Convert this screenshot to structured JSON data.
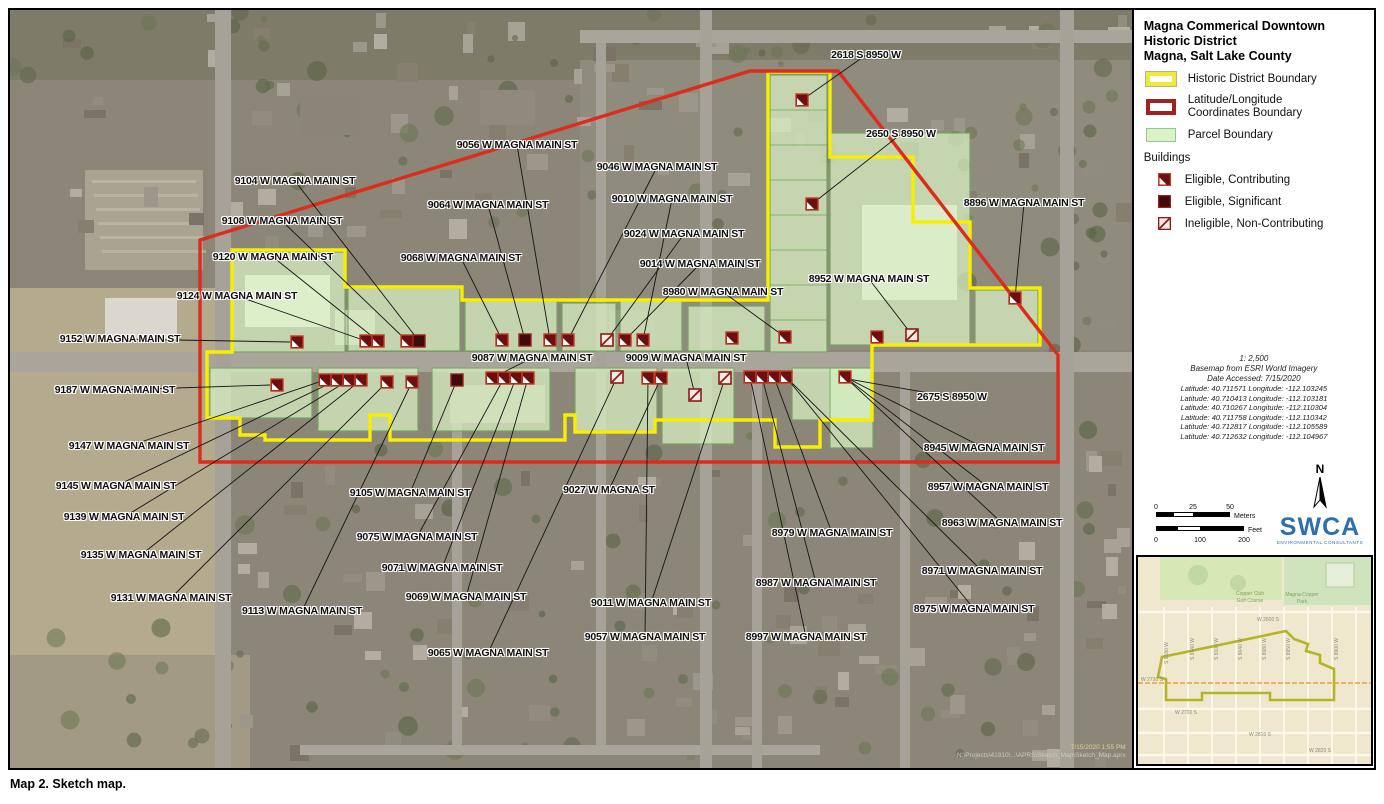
{
  "caption": "Map 2. Sketch map.",
  "legend": {
    "title_lines": [
      "Magna Commerical Downtown",
      "Historic District",
      "Magna, Salt Lake County"
    ],
    "items": [
      {
        "label": "Historic District Boundary",
        "swatch": "yellow",
        "color": "#f2e83a"
      },
      {
        "label": "Latitude/Longitude\nCoordinates Boundary",
        "swatch": "red",
        "color": "#9e2123"
      },
      {
        "label": "Parcel Boundary",
        "swatch": "green",
        "color": "#daf2c6"
      }
    ],
    "buildings_header": "Buildings",
    "building_types": [
      {
        "type": "c",
        "label": "Eligible, Contributing"
      },
      {
        "type": "s",
        "label": "Eligible, Significant"
      },
      {
        "type": "n",
        "label": "Ineligible, Non-Contributing"
      }
    ]
  },
  "scale_info": {
    "ratio": "1: 2,500",
    "basemap": "Basemap from ESRI World Imagery",
    "date": "Date Accessed: 7/15/2020",
    "coordinates": [
      "Latitude: 40.711571 Longitude: -112.103245",
      "Latitude: 40.710413 Longitude: -112.103181",
      "Latitude: 40.710267 Longitude: -112.110304",
      "Latitude: 40.711758 Longitude: -112.110342",
      "Latitude: 40.712817 Longitude: -112.105589",
      "Latitude: 40.712632 Longitude: -112.104967"
    ]
  },
  "scale_bar": {
    "meters_ticks": [
      "0",
      "25",
      "50"
    ],
    "meters_label": "Meters",
    "feet_ticks": [
      "0",
      "100",
      "200"
    ],
    "feet_label": "Feet"
  },
  "north_label": "N",
  "logo": {
    "text": "SWCA",
    "subtext": "ENVIRONMENTAL CONSULTANTS"
  },
  "map": {
    "boundary_colors": {
      "historic": "#f7ee00",
      "latlong": "#dd2b1c",
      "parcel_fill": "#d9f2c4",
      "parcel_stroke": "#6fae57"
    },
    "stamp": [
      "7/15/2020 1:55 PM",
      "N:\\Projects\\41910\\...\\APRS\\Sketch_Map\\Sketch_Map.aprx"
    ],
    "labels": [
      {
        "t": "2618 S 8950 W",
        "x": 866,
        "y": 55,
        "lead": [
          802,
          100
        ]
      },
      {
        "t": "2650 S 8950 W",
        "x": 901,
        "y": 134,
        "lead": [
          812,
          204
        ]
      },
      {
        "t": "9056 W MAGNA MAIN ST",
        "x": 517,
        "y": 145,
        "lead": [
          550,
          340
        ]
      },
      {
        "t": "9046 W MAGNA MAIN ST",
        "x": 657,
        "y": 167,
        "lead": [
          568,
          340
        ]
      },
      {
        "t": "9104 W MAGNA MAIN ST",
        "x": 295,
        "y": 181,
        "lead": [
          419,
          341
        ]
      },
      {
        "t": "9010 W MAGNA MAIN ST",
        "x": 672,
        "y": 199,
        "lead": [
          643,
          340
        ]
      },
      {
        "t": "8896 W MAGNA MAIN ST",
        "x": 1024,
        "y": 203,
        "lead": [
          1015,
          298
        ]
      },
      {
        "t": "9064 W MAGNA MAIN ST",
        "x": 488,
        "y": 205,
        "lead": [
          525,
          340
        ]
      },
      {
        "t": "9108 W MAGNA MAIN ST",
        "x": 282,
        "y": 221,
        "lead": [
          407,
          341
        ]
      },
      {
        "t": "9024 W MAGNA MAIN ST",
        "x": 684,
        "y": 234,
        "lead": [
          607,
          340
        ]
      },
      {
        "t": "9120 W MAGNA MAIN ST",
        "x": 273,
        "y": 257,
        "lead": [
          378,
          341
        ]
      },
      {
        "t": "9068 W MAGNA MAIN ST",
        "x": 461,
        "y": 258,
        "lead": [
          502,
          340
        ]
      },
      {
        "t": "9014 W MAGNA MAIN ST",
        "x": 700,
        "y": 264,
        "lead": [
          625,
          340
        ]
      },
      {
        "t": "8952 W MAGNA MAIN ST",
        "x": 869,
        "y": 279,
        "lead": [
          912,
          335
        ]
      },
      {
        "t": "8980 W MAGNA MAIN ST",
        "x": 723,
        "y": 292,
        "lead": [
          785,
          337
        ]
      },
      {
        "t": "9124 W MAGNA MAIN ST",
        "x": 237,
        "y": 296,
        "lead": [
          366,
          341
        ]
      },
      {
        "t": "9152 W MAGNA MAIN ST",
        "x": 120,
        "y": 339,
        "lead": [
          290,
          342
        ]
      },
      {
        "t": "9087 W MAGNA MAIN ST",
        "x": 532,
        "y": 358,
        "lead": [
          492,
          378
        ]
      },
      {
        "t": "9009 W MAGNA MAIN ST",
        "x": 686,
        "y": 358,
        "lead": [
          695,
          395
        ]
      },
      {
        "t": "9187 W MAGNA MAIN ST",
        "x": 115,
        "y": 390,
        "lead": [
          270,
          385
        ]
      },
      {
        "t": "2675 S 8950 W",
        "x": 952,
        "y": 397,
        "lead": [
          848,
          379
        ]
      },
      {
        "t": "9147 W MAGNA MAIN ST",
        "x": 129,
        "y": 446,
        "lead": [
          325,
          380
        ]
      },
      {
        "t": "8945 W MAGNA MAIN ST",
        "x": 984,
        "y": 448,
        "lead": [
          845,
          377
        ]
      },
      {
        "t": "9145 W MAGNA MAIN ST",
        "x": 116,
        "y": 486,
        "lead": [
          337,
          380
        ]
      },
      {
        "t": "9105 W MAGNA MAIN ST",
        "x": 410,
        "y": 493,
        "lead": [
          457,
          380
        ]
      },
      {
        "t": "9027 W MAGNA ST",
        "x": 609,
        "y": 490,
        "lead": [
          661,
          378
        ]
      },
      {
        "t": "8957 W MAGNA MAIN ST",
        "x": 988,
        "y": 487,
        "lead": [
          845,
          377
        ]
      },
      {
        "t": "9139 W MAGNA MAIN ST",
        "x": 124,
        "y": 517,
        "lead": [
          349,
          380
        ]
      },
      {
        "t": "8963 W MAGNA MAIN ST",
        "x": 1002,
        "y": 523,
        "lead": [
          845,
          377
        ]
      },
      {
        "t": "9075 W MAGNA MAIN ST",
        "x": 417,
        "y": 537,
        "lead": [
          504,
          378
        ]
      },
      {
        "t": "8979 W MAGNA MAIN ST",
        "x": 832,
        "y": 533,
        "lead": [
          774,
          377
        ]
      },
      {
        "t": "9135 W MAGNA MAIN ST",
        "x": 141,
        "y": 555,
        "lead": [
          361,
          380
        ]
      },
      {
        "t": "9071 W MAGNA MAIN ST",
        "x": 442,
        "y": 568,
        "lead": [
          516,
          378
        ]
      },
      {
        "t": "8971 W MAGNA MAIN ST",
        "x": 982,
        "y": 571,
        "lead": [
          786,
          377
        ]
      },
      {
        "t": "9069 W MAGNA MAIN ST",
        "x": 466,
        "y": 597,
        "lead": [
          528,
          378
        ]
      },
      {
        "t": "9011 W MAGNA MAIN ST",
        "x": 651,
        "y": 603,
        "lead": [
          725,
          378
        ]
      },
      {
        "t": "9131 W MAGNA MAIN ST",
        "x": 171,
        "y": 598,
        "lead": [
          387,
          382
        ]
      },
      {
        "t": "9113 W MAGNA MAIN ST",
        "x": 302,
        "y": 611,
        "lead": [
          412,
          382
        ]
      },
      {
        "t": "8987 W MAGNA MAIN ST",
        "x": 816,
        "y": 583,
        "lead": [
          762,
          377
        ]
      },
      {
        "t": "8975 W MAGNA MAIN ST",
        "x": 974,
        "y": 609,
        "lead": [
          786,
          377
        ]
      },
      {
        "t": "8997 W MAGNA MAIN ST",
        "x": 806,
        "y": 637,
        "lead": [
          750,
          377
        ]
      },
      {
        "t": "9057 W MAGNA MAIN ST",
        "x": 645,
        "y": 637,
        "lead": [
          648,
          378
        ]
      },
      {
        "t": "9065 W MAGNA MAIN ST",
        "x": 488,
        "y": 653,
        "lead": [
          617,
          377
        ]
      }
    ],
    "markers": [
      {
        "x": 297,
        "y": 342,
        "t": "c"
      },
      {
        "x": 366,
        "y": 341,
        "t": "c"
      },
      {
        "x": 378,
        "y": 341,
        "t": "c"
      },
      {
        "x": 407,
        "y": 341,
        "t": "c"
      },
      {
        "x": 419,
        "y": 341,
        "t": "s"
      },
      {
        "x": 502,
        "y": 340,
        "t": "c"
      },
      {
        "x": 525,
        "y": 340,
        "t": "s"
      },
      {
        "x": 550,
        "y": 340,
        "t": "c"
      },
      {
        "x": 568,
        "y": 340,
        "t": "c"
      },
      {
        "x": 607,
        "y": 340,
        "t": "n"
      },
      {
        "x": 625,
        "y": 340,
        "t": "c"
      },
      {
        "x": 643,
        "y": 340,
        "t": "c"
      },
      {
        "x": 732,
        "y": 338,
        "t": "c"
      },
      {
        "x": 785,
        "y": 337,
        "t": "c"
      },
      {
        "x": 877,
        "y": 337,
        "t": "c"
      },
      {
        "x": 912,
        "y": 335,
        "t": "n"
      },
      {
        "x": 1015,
        "y": 298,
        "t": "c"
      },
      {
        "x": 802,
        "y": 100,
        "t": "c"
      },
      {
        "x": 812,
        "y": 204,
        "t": "c"
      },
      {
        "x": 277,
        "y": 385,
        "t": "c"
      },
      {
        "x": 325,
        "y": 380,
        "t": "c"
      },
      {
        "x": 337,
        "y": 380,
        "t": "c"
      },
      {
        "x": 349,
        "y": 380,
        "t": "c"
      },
      {
        "x": 361,
        "y": 380,
        "t": "c"
      },
      {
        "x": 387,
        "y": 382,
        "t": "c"
      },
      {
        "x": 412,
        "y": 382,
        "t": "c"
      },
      {
        "x": 457,
        "y": 380,
        "t": "s"
      },
      {
        "x": 492,
        "y": 378,
        "t": "c"
      },
      {
        "x": 504,
        "y": 378,
        "t": "c"
      },
      {
        "x": 516,
        "y": 378,
        "t": "c"
      },
      {
        "x": 528,
        "y": 378,
        "t": "c"
      },
      {
        "x": 617,
        "y": 377,
        "t": "n"
      },
      {
        "x": 648,
        "y": 378,
        "t": "c"
      },
      {
        "x": 661,
        "y": 378,
        "t": "c"
      },
      {
        "x": 695,
        "y": 395,
        "t": "n"
      },
      {
        "x": 725,
        "y": 378,
        "t": "n"
      },
      {
        "x": 750,
        "y": 377,
        "t": "c"
      },
      {
        "x": 762,
        "y": 377,
        "t": "c"
      },
      {
        "x": 774,
        "y": 377,
        "t": "c"
      },
      {
        "x": 786,
        "y": 377,
        "t": "c"
      },
      {
        "x": 845,
        "y": 377,
        "t": "c"
      }
    ]
  },
  "inset": {
    "area_labels": [
      {
        "t": "Copper Club",
        "x": 112,
        "y": 38
      },
      {
        "t": "Golf Course",
        "x": 112,
        "y": 45
      },
      {
        "t": "Magna-Copper",
        "x": 164,
        "y": 39
      },
      {
        "t": "Park",
        "x": 164,
        "y": 46
      }
    ],
    "street_labels": [
      {
        "t": "W 2600 S",
        "x": 130,
        "y": 64
      },
      {
        "t": "W 2730 S",
        "x": 14,
        "y": 124
      },
      {
        "t": "W 2700 S",
        "x": 48,
        "y": 157
      },
      {
        "t": "W 2810 S",
        "x": 122,
        "y": 179
      },
      {
        "t": "W 2820 S",
        "x": 182,
        "y": 195
      },
      {
        "t": "S 9180 W",
        "x": 30,
        "y": 96,
        "r": 1
      },
      {
        "t": "S 9140 W",
        "x": 56,
        "y": 92,
        "r": 1
      },
      {
        "t": "S 9100 W",
        "x": 80,
        "y": 92,
        "r": 1
      },
      {
        "t": "S 9040 W",
        "x": 104,
        "y": 92,
        "r": 1
      },
      {
        "t": "S 8980 W",
        "x": 128,
        "y": 92,
        "r": 1
      },
      {
        "t": "S 8950 W",
        "x": 152,
        "y": 92,
        "r": 1
      },
      {
        "t": "S 8900 W",
        "x": 200,
        "y": 92,
        "r": 1
      }
    ]
  }
}
